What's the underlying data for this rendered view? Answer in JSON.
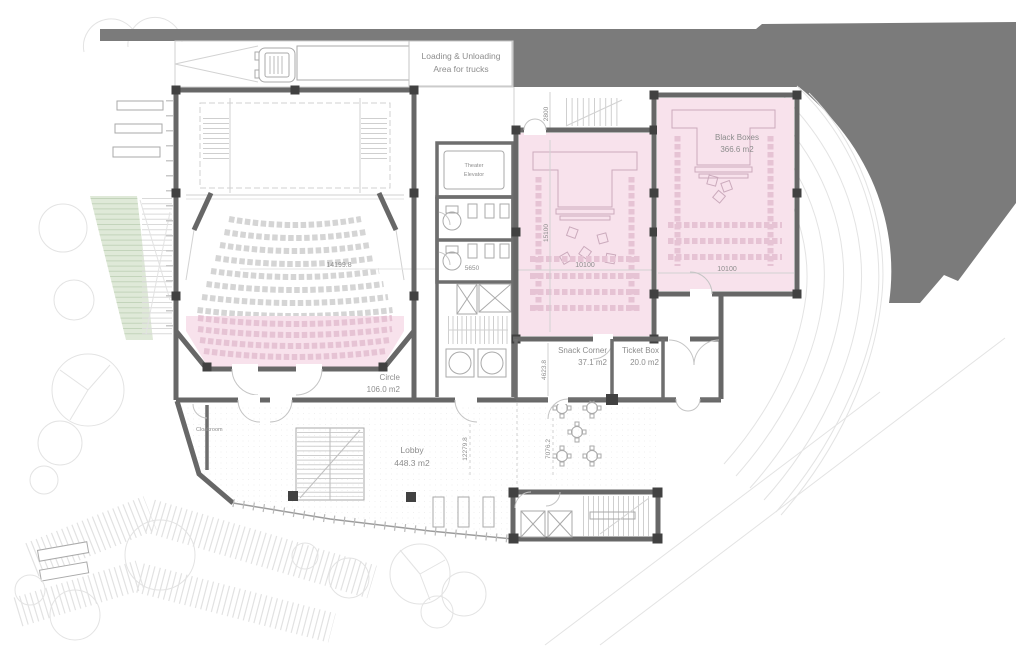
{
  "drawing_title": "Theater ground floor plan",
  "colors": {
    "site_context": "#7b7b7b",
    "wall": "#676767",
    "column": "#414141",
    "pink_room": "#f8e2ec",
    "pink_seat": "#e6c3d4",
    "green_steps": "#dfe9d8",
    "drawing_line": "#d2d2d2",
    "label_text": "#8d8d8d"
  },
  "labels": {
    "loading": [
      "Loading & Unloading",
      "Area for trucks"
    ],
    "theater_elevator": [
      "Theater",
      "Elevator"
    ],
    "black_boxes": [
      "Black Boxes",
      "366.6 m2"
    ],
    "snack_corner": [
      "Snack Corner",
      "37.1 m2"
    ],
    "ticket_box": [
      "Ticket Box",
      "20.0 m2"
    ],
    "circle": [
      "Circle",
      "106.0 m2"
    ],
    "lobby": [
      "Lobby",
      "448.3 m2"
    ],
    "cloakroom": "Cloakroom"
  },
  "dimensions": {
    "theater_width": "14199.8",
    "wc_width": "5650",
    "black_box_height": "15100",
    "black_box_width": "10100",
    "black_boxes_width": "10100",
    "dock_depth": "2800",
    "snack_height": "4623.8",
    "lobby_depth": "12279.8",
    "lobby_east_depth": "7076.2"
  }
}
